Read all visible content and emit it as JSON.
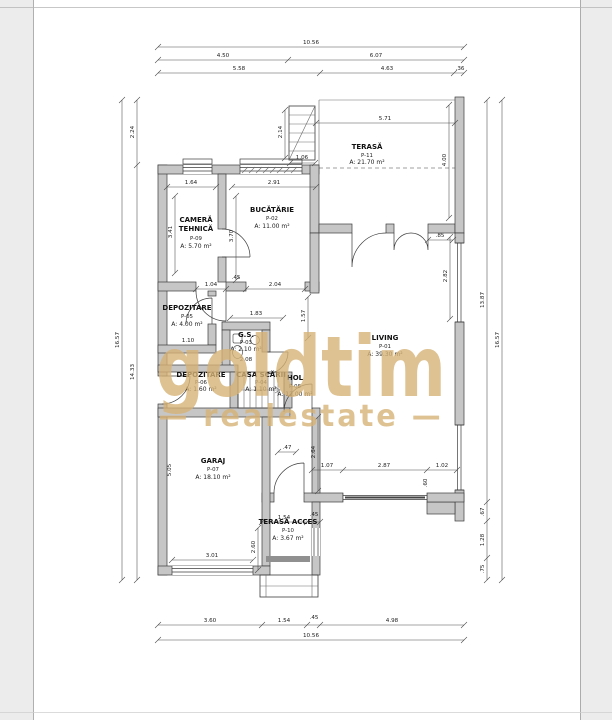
{
  "watermark": {
    "brand": "goldtim",
    "tagline": "— realestate —",
    "color": "#d7b377"
  },
  "colors": {
    "wall": "#c6c6c6",
    "paper": "#ffffff",
    "margin": "#ececec"
  },
  "rooms": [
    {
      "id": "terasa",
      "name": "TERASĂ",
      "code": "P-11",
      "area": "A: 21.70 m²"
    },
    {
      "id": "bucatarie",
      "name": "BUCĂTĂRIE",
      "code": "P-02",
      "area": "A: 11.00 m²"
    },
    {
      "id": "camera-tehnica",
      "name": "CAMERĂ",
      "name2": "TEHNICĂ",
      "code": "P-09",
      "area": "A: 5.70 m²"
    },
    {
      "id": "depozitare-1",
      "name": "DEPOZITARE",
      "code": "P-05",
      "area": "A: 4.00 m²"
    },
    {
      "id": "gs",
      "name": "G.S.",
      "code": "P-03",
      "area": "A: 2.10 m²"
    },
    {
      "id": "depozitare-2",
      "name": "DEPOZITARE",
      "code": "P-06",
      "area": "A: 1.60 m²"
    },
    {
      "id": "casa-scarii",
      "name": "CASA SCĂRII",
      "code": "P-04",
      "area": "A: 1.10 m²"
    },
    {
      "id": "hol",
      "name": "HOL",
      "code": "P-08",
      "area": "A: 12.00 m²"
    },
    {
      "id": "living",
      "name": "LIVING",
      "code": "P-01",
      "area": "A: 39.30 m²"
    },
    {
      "id": "garaj",
      "name": "GARAJ",
      "code": "P-07",
      "area": "A: 18.10 m²"
    },
    {
      "id": "terasa-acces",
      "name": "TERASĂ ACCES",
      "code": "P-10",
      "area": "A: 3.67 m²"
    }
  ],
  "dims": {
    "top_total": "10.56",
    "top_a1": "4.50",
    "top_a2": "6.07",
    "top_b1": "5.58",
    "top_b2": "4.63",
    "top_b3": ".36",
    "bottom_a1": "3.60",
    "bottom_a2": "1.54",
    "bottom_a3": ".45",
    "bottom_a4": "4.98",
    "bottom_total": "10.56",
    "left_total": "16.57",
    "left_a1": "2.24",
    "left_a2": "14.33",
    "right_a1": "13.87",
    "right_a2": ".67",
    "right_a3": "1.28",
    "right_a4": ".75",
    "right_total": "16.57",
    "terasa_w": "5.71",
    "terasa_h": "4.00",
    "stair_h": "2.14",
    "stair_w": "1.06",
    "kitchen_w": "2.91",
    "kitchen_h": "3.70",
    "tech_w": "1.64",
    "tech_h": "3.41",
    "hall_a": "1.04",
    "hall_b": "2.04",
    "hall_c": ".45",
    "hall_d": "1.57",
    "gs_w": "1.83",
    "gs_h": "2.08",
    "dep_w": "1.10",
    "living_win_h": "2.82",
    "living_top_r": ".85",
    "living_left_h": "2.64",
    "living_b1": "1.07",
    "living_b2": "2.87",
    "living_b3": "1.02",
    "living_b4": ".60",
    "garage_w": "3.01",
    "garage_h": "5.05",
    "garage_r": ".47",
    "acc_w": "1.54",
    "acc_w2": ".45",
    "acc_h": "2.60"
  }
}
